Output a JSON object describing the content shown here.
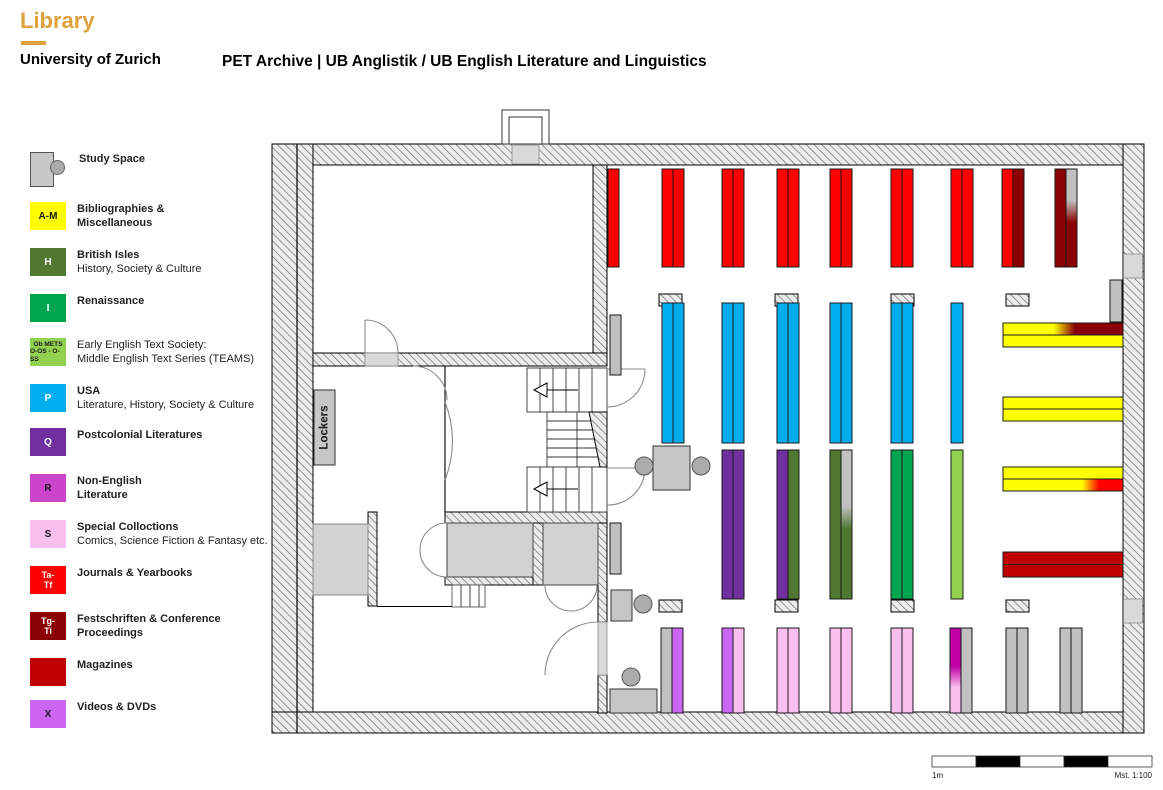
{
  "header": {
    "brand": "Library",
    "org": "University of Zurich",
    "title": "PET Archive | UB Anglistik / UB English Literature and Linguistics"
  },
  "palette": {
    "gold": "#DFA13C",
    "red": "#FF0000",
    "darkred": "#8B0000",
    "mag": "#C00000",
    "yellow": "#FFFF00",
    "cyan": "#00AEEF",
    "purple": "#7030A0",
    "olive": "#507831",
    "green": "#00A550",
    "lightgreen": "#92D050",
    "pink": "#F9BFEF",
    "violet": "#CC66F2",
    "magenta": "#C000A5",
    "orchid": "#CC44CC",
    "grayshelf": "#C0C0C0",
    "gray_furniture": "#C8C8C8",
    "lightgray": "#D9D9D9"
  },
  "legend": {
    "items": [
      {
        "code1": "",
        "code2": "",
        "l1": "Study Space",
        "l2": ""
      },
      {
        "code1": "A-M",
        "code2": "",
        "l1": "Bibliographies &",
        "l2": "Miscellaneous"
      },
      {
        "code1": "H",
        "code2": "",
        "l1": "British Isles",
        "l2": "History, Society & Culture"
      },
      {
        "code1": "I",
        "code2": "",
        "l1": "Renaissance",
        "l2": ""
      },
      {
        "code1": "Ob METS",
        "code2": "O-OS - O-SS",
        "l1": "Early English Text Society:",
        "l2": "Middle English Text Series (TEAMS)"
      },
      {
        "code1": "P",
        "code2": "",
        "l1": "USA",
        "l2": "Literature, History, Society & Culture"
      },
      {
        "code1": "Q",
        "code2": "",
        "l1": "Postcolonial Literatures",
        "l2": ""
      },
      {
        "code1": "R",
        "code2": "",
        "l1": "Non-English",
        "l2": "Literature"
      },
      {
        "code1": "S",
        "code2": "",
        "l1": "Special Colloctions",
        "l2": "Comics, Science Fiction & Fantasy etc."
      },
      {
        "code1": "Ta-",
        "code2": "Tf",
        "l1": "Journals & Yearbooks",
        "l2": ""
      },
      {
        "code1": "Tg-",
        "code2": "Ti",
        "l1": "Festschriften & Conference",
        "l2": "Proceedings"
      },
      {
        "code1": "",
        "code2": "",
        "l1": "Magazines",
        "l2": ""
      },
      {
        "code1": "X",
        "code2": "",
        "l1": "Videos & DVDs",
        "l2": ""
      }
    ]
  },
  "plan": {
    "lockers_label": "Lockers",
    "scale_left": "1m",
    "scale_right": "Mst. 1:100"
  }
}
